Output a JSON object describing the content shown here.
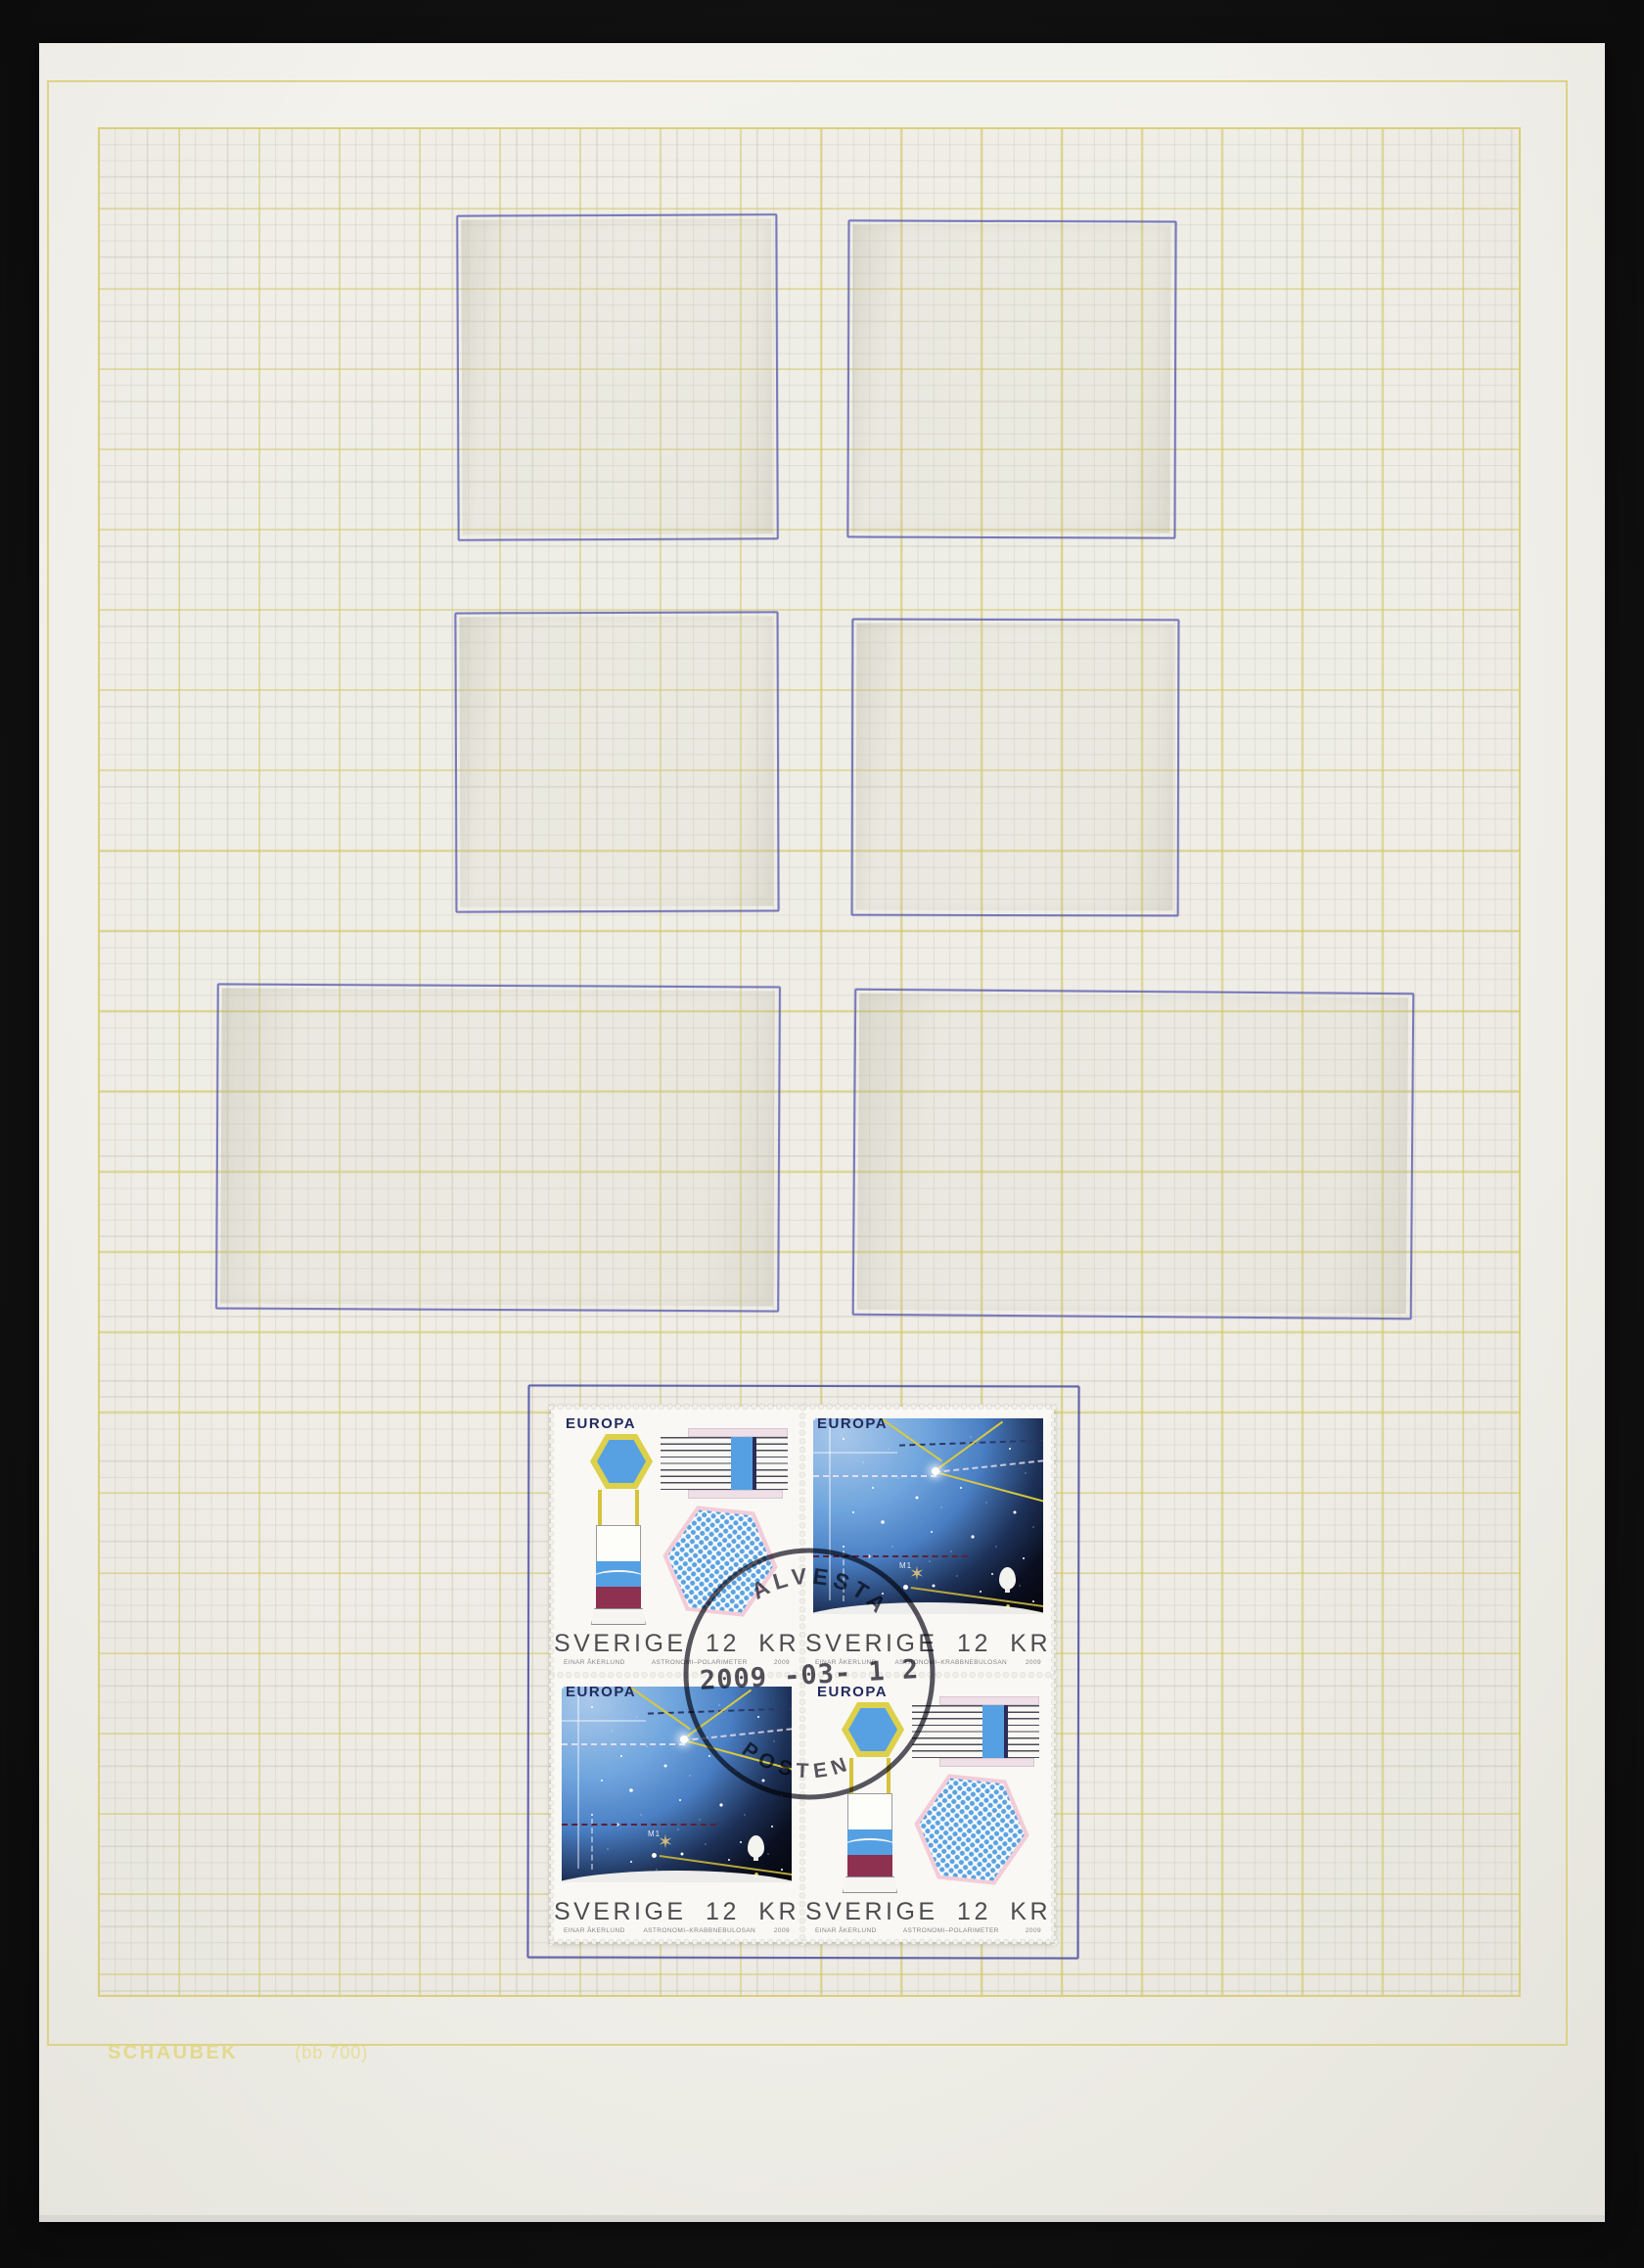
{
  "album": {
    "brand": "SCHAUBEK",
    "page_code": "(bb 700)"
  },
  "postmark": {
    "town": "ALVESTA",
    "date": "2009 -03- 1 2",
    "carrier": "POSTEN"
  },
  "stamps": [
    {
      "position": "top-left",
      "design": "instruments",
      "logo": "EUROPA",
      "denomination": "SVERIGE 12 KR",
      "engraver": "EINAR ÅKERLUND",
      "title": "ASTRONOMI–POLARIMETER",
      "year": "2009"
    },
    {
      "position": "top-right",
      "design": "starfield",
      "logo": "EUROPA",
      "denomination": "SVERIGE 12 KR",
      "engraver": "EINAR ÅKERLUND",
      "title": "ASTRONOMI–KRABBNEBULOSAN",
      "year": "2009",
      "nebula_label": "M1"
    },
    {
      "position": "bottom-left",
      "design": "starfield",
      "logo": "EUROPA",
      "denomination": "SVERIGE 12 KR",
      "engraver": "EINAR ÅKERLUND",
      "title": "ASTRONOMI–KRABBNEBULOSAN",
      "year": "2009",
      "nebula_label": "M1"
    },
    {
      "position": "bottom-right",
      "design": "instruments",
      "logo": "EUROPA",
      "denomination": "SVERIGE 12 KR",
      "engraver": "EINAR ÅKERLUND",
      "title": "ASTRONOMI–POLARIMETER",
      "year": "2009"
    }
  ],
  "colors": {
    "page": "#f1f0ea",
    "grid_major": "#d4ca60",
    "ink_outline": "#5658b0",
    "stamp_blue": "#55a0e2",
    "stamp_yellow": "#ddd04a",
    "stamp_maroon": "#8e3050",
    "postmark_ink": "#413f4b",
    "background": "#111111"
  }
}
